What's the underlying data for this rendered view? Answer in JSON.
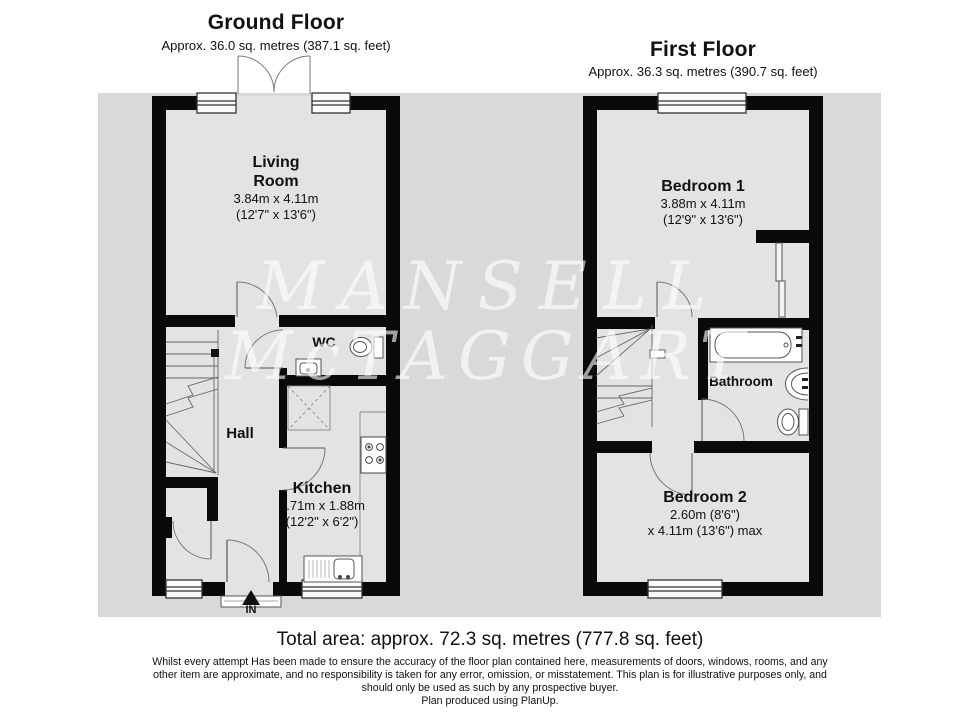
{
  "page": {
    "plan_bg_color": "#d9d9d9",
    "wall_color": "#000000",
    "watermark": {
      "line1": "MANSELL",
      "line2": "McTAGGART"
    }
  },
  "ground_floor": {
    "title": "Ground Floor",
    "subtitle": "Approx. 36.0 sq. metres (387.1 sq. feet)",
    "rooms": {
      "living_room": {
        "name_line1": "Living",
        "name_line2": "Room",
        "dims_metric": "3.84m x 4.11m",
        "dims_imperial": "(12'7\" x 13'6\")"
      },
      "wc": {
        "name": "WC"
      },
      "hall": {
        "name": "Hall"
      },
      "kitchen": {
        "name": "Kitchen",
        "dims_metric": "3.71m x 1.88m",
        "dims_imperial": "(12'2\" x 6'2\")"
      }
    },
    "entrance_label": "IN"
  },
  "first_floor": {
    "title": "First Floor",
    "subtitle": "Approx. 36.3 sq. metres (390.7 sq. feet)",
    "rooms": {
      "bedroom1": {
        "name": "Bedroom 1",
        "dims_metric": "3.88m x 4.11m",
        "dims_imperial": "(12'9\" x 13'6\")"
      },
      "bathroom": {
        "name": "Bathroom"
      },
      "bedroom2": {
        "name": "Bedroom 2",
        "dims_line1": "2.60m (8'6\")",
        "dims_line2": "x 4.11m (13'6\") max"
      }
    }
  },
  "footer": {
    "total_area": "Total area: approx. 72.3 sq. metres (777.8 sq. feet)",
    "disclaimer": "Whilst every attempt Has been made to ensure the accuracy of the floor plan contained here, measurements of doors, windows, rooms, and any other item are approximate, and no responsibility is taken for any error, omission, or misstatement. This plan is for illustrative purposes only, and should only be used as such by any prospective buyer.",
    "produced_by": "Plan produced using PlanUp."
  }
}
